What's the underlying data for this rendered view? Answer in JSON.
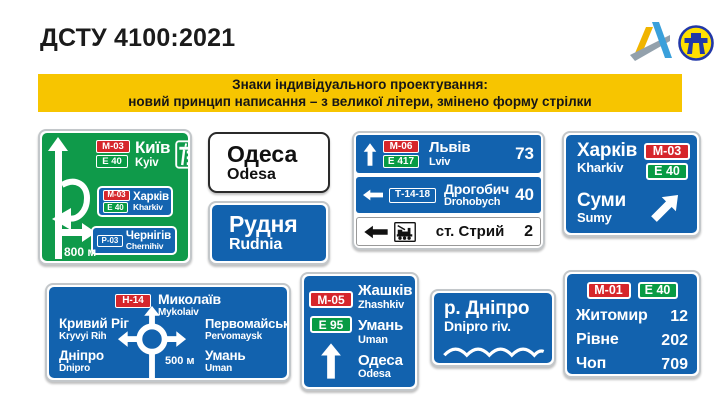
{
  "slide": {
    "title": "ДСТУ 4100:2021"
  },
  "banner": {
    "line1": "Знаки індивідуального проектування:",
    "line2": "новий принцип написання – з великої літери, змінено форму стрілки"
  },
  "colors": {
    "banner_yellow": "#F7C500",
    "sign_blue": "#1262AE",
    "sign_green": "#0F9A4A",
    "badge_red": "#D6262B",
    "badge_green": "#089B44",
    "badge_blue": "#1566B2"
  },
  "icons": [
    "ukravtodor-logo",
    "road-agency-emblem",
    "motorway-icon",
    "railway-station-icon",
    "up-arrow",
    "left-arrow",
    "up-right-arrow",
    "u-turn-branch-arrow",
    "roundabout-symbol",
    "water-wave"
  ],
  "signs": {
    "green_advance": {
      "main": {
        "route": "М-03",
        "eroad": "E 40",
        "name": "Київ",
        "latin": "Kyiv"
      },
      "inset1": {
        "route": "М-03",
        "eroad": "E 40",
        "name": "Харків",
        "latin": "Kharkiv"
      },
      "inset2": {
        "route": "Р-03",
        "name": "Чернігів",
        "latin": "Chernihiv"
      },
      "distance": "800 м"
    },
    "odesa": {
      "name": "Одеса",
      "latin": "Odesa"
    },
    "rudnia": {
      "name": "Рудня",
      "latin": "Rudnia"
    },
    "lviv_panel": {
      "row1": {
        "route": "М-06",
        "eroad": "E 417",
        "name": "Львів",
        "latin": "Lviv",
        "km": "73"
      },
      "row2": {
        "route": "Т-14-18",
        "name": "Дрогобич",
        "latin": "Drohobych",
        "km": "40"
      },
      "row3": {
        "name": "ст. Стрий",
        "km": "2"
      }
    },
    "kharkiv_sumy": {
      "dest1": {
        "name": "Харків",
        "latin": "Kharkiv"
      },
      "route": "М-03",
      "eroad": "E 40",
      "dest2": {
        "name": "Суми",
        "latin": "Sumy"
      }
    },
    "roundabout": {
      "route": "Н-14",
      "top": {
        "name": "Миколаїв",
        "latin": "Mykolaiv"
      },
      "left1": {
        "name": "Кривий Ріг",
        "latin": "Kryvyi Rih"
      },
      "left2": {
        "name": "Дніпро",
        "latin": "Dnipro"
      },
      "right1": {
        "name": "Первомайськ",
        "latin": "Pervomaysk"
      },
      "right2": {
        "name": "Умань",
        "latin": "Uman"
      },
      "distance": "500 м"
    },
    "zhashkiv": {
      "route": "М-05",
      "eroad": "E 95",
      "dest1": {
        "name": "Жашків",
        "latin": "Zhashkiv"
      },
      "dest2": {
        "name": "Умань",
        "latin": "Uman"
      },
      "dest3": {
        "name": "Одеса",
        "latin": "Odesa"
      }
    },
    "dnipro_river": {
      "name": "р. Дніпро",
      "latin": "Dnipro riv."
    },
    "distance_table": {
      "route": "М-01",
      "eroad": "E 40",
      "rows": [
        {
          "name": "Житомир",
          "km": "12"
        },
        {
          "name": "Рівне",
          "km": "202"
        },
        {
          "name": "Чоп",
          "km": "709"
        }
      ]
    }
  }
}
